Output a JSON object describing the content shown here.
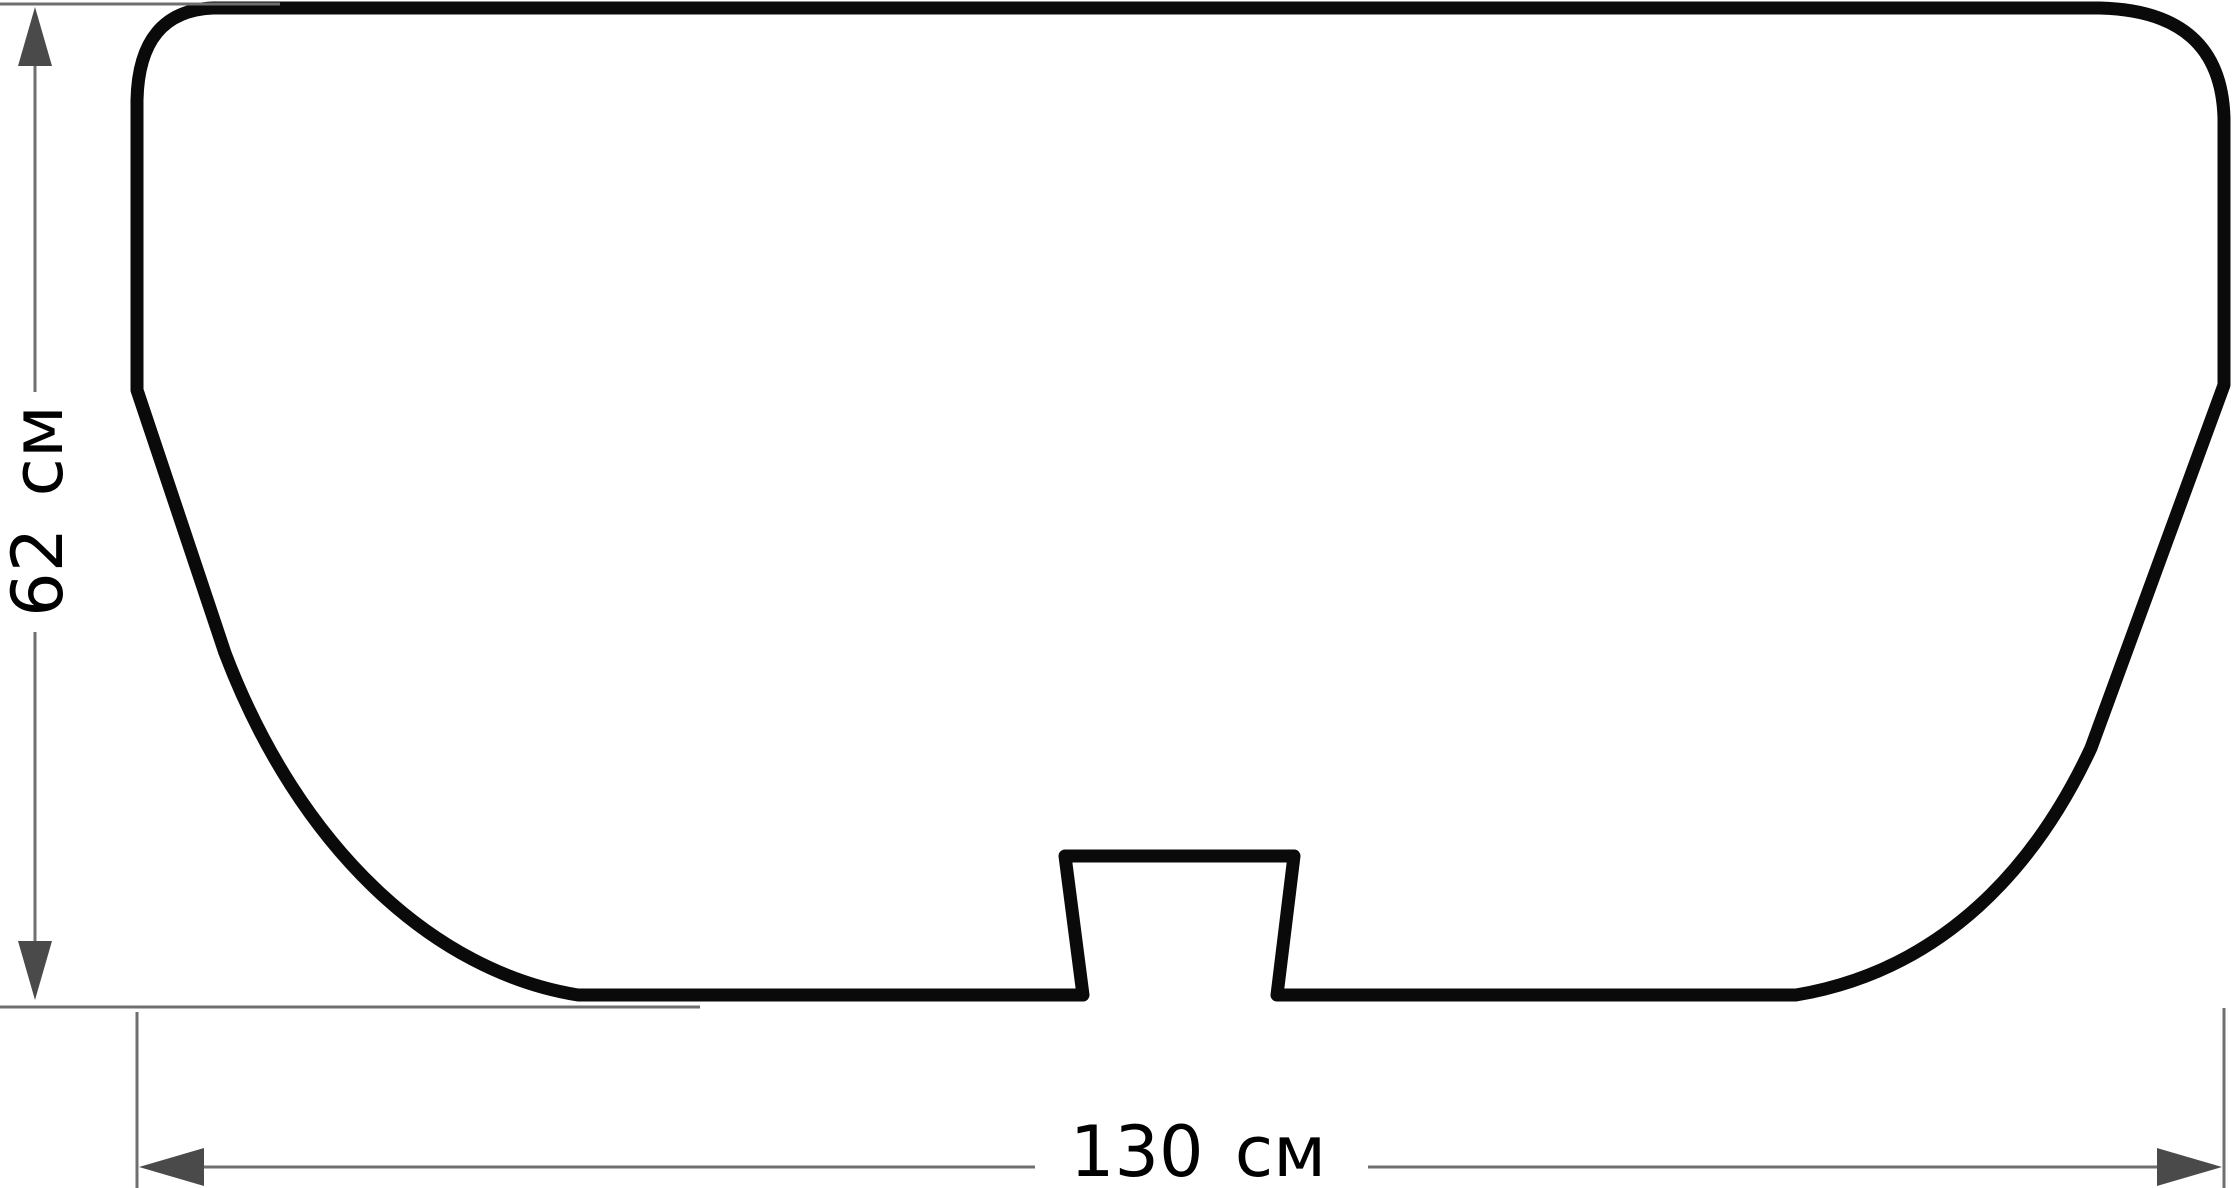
{
  "diagram": {
    "type": "technical-dimension-drawing",
    "height_dimension": {
      "label": "62 см",
      "value": "62",
      "unit": "см",
      "orientation": "vertical"
    },
    "width_dimension": {
      "label": "130 см",
      "value": "130",
      "unit": "см",
      "orientation": "horizontal"
    },
    "colors": {
      "background": "#ffffff",
      "outline": "#0a0a0a",
      "dimension_lines": "#6f6f6f",
      "arrowheads": "#4a4a4a",
      "labels": "#000000"
    },
    "icons": {
      "up_arrowhead": "▲",
      "down_arrowhead": "▼",
      "left_arrowhead": "◀",
      "right_arrowhead": "▶"
    }
  }
}
